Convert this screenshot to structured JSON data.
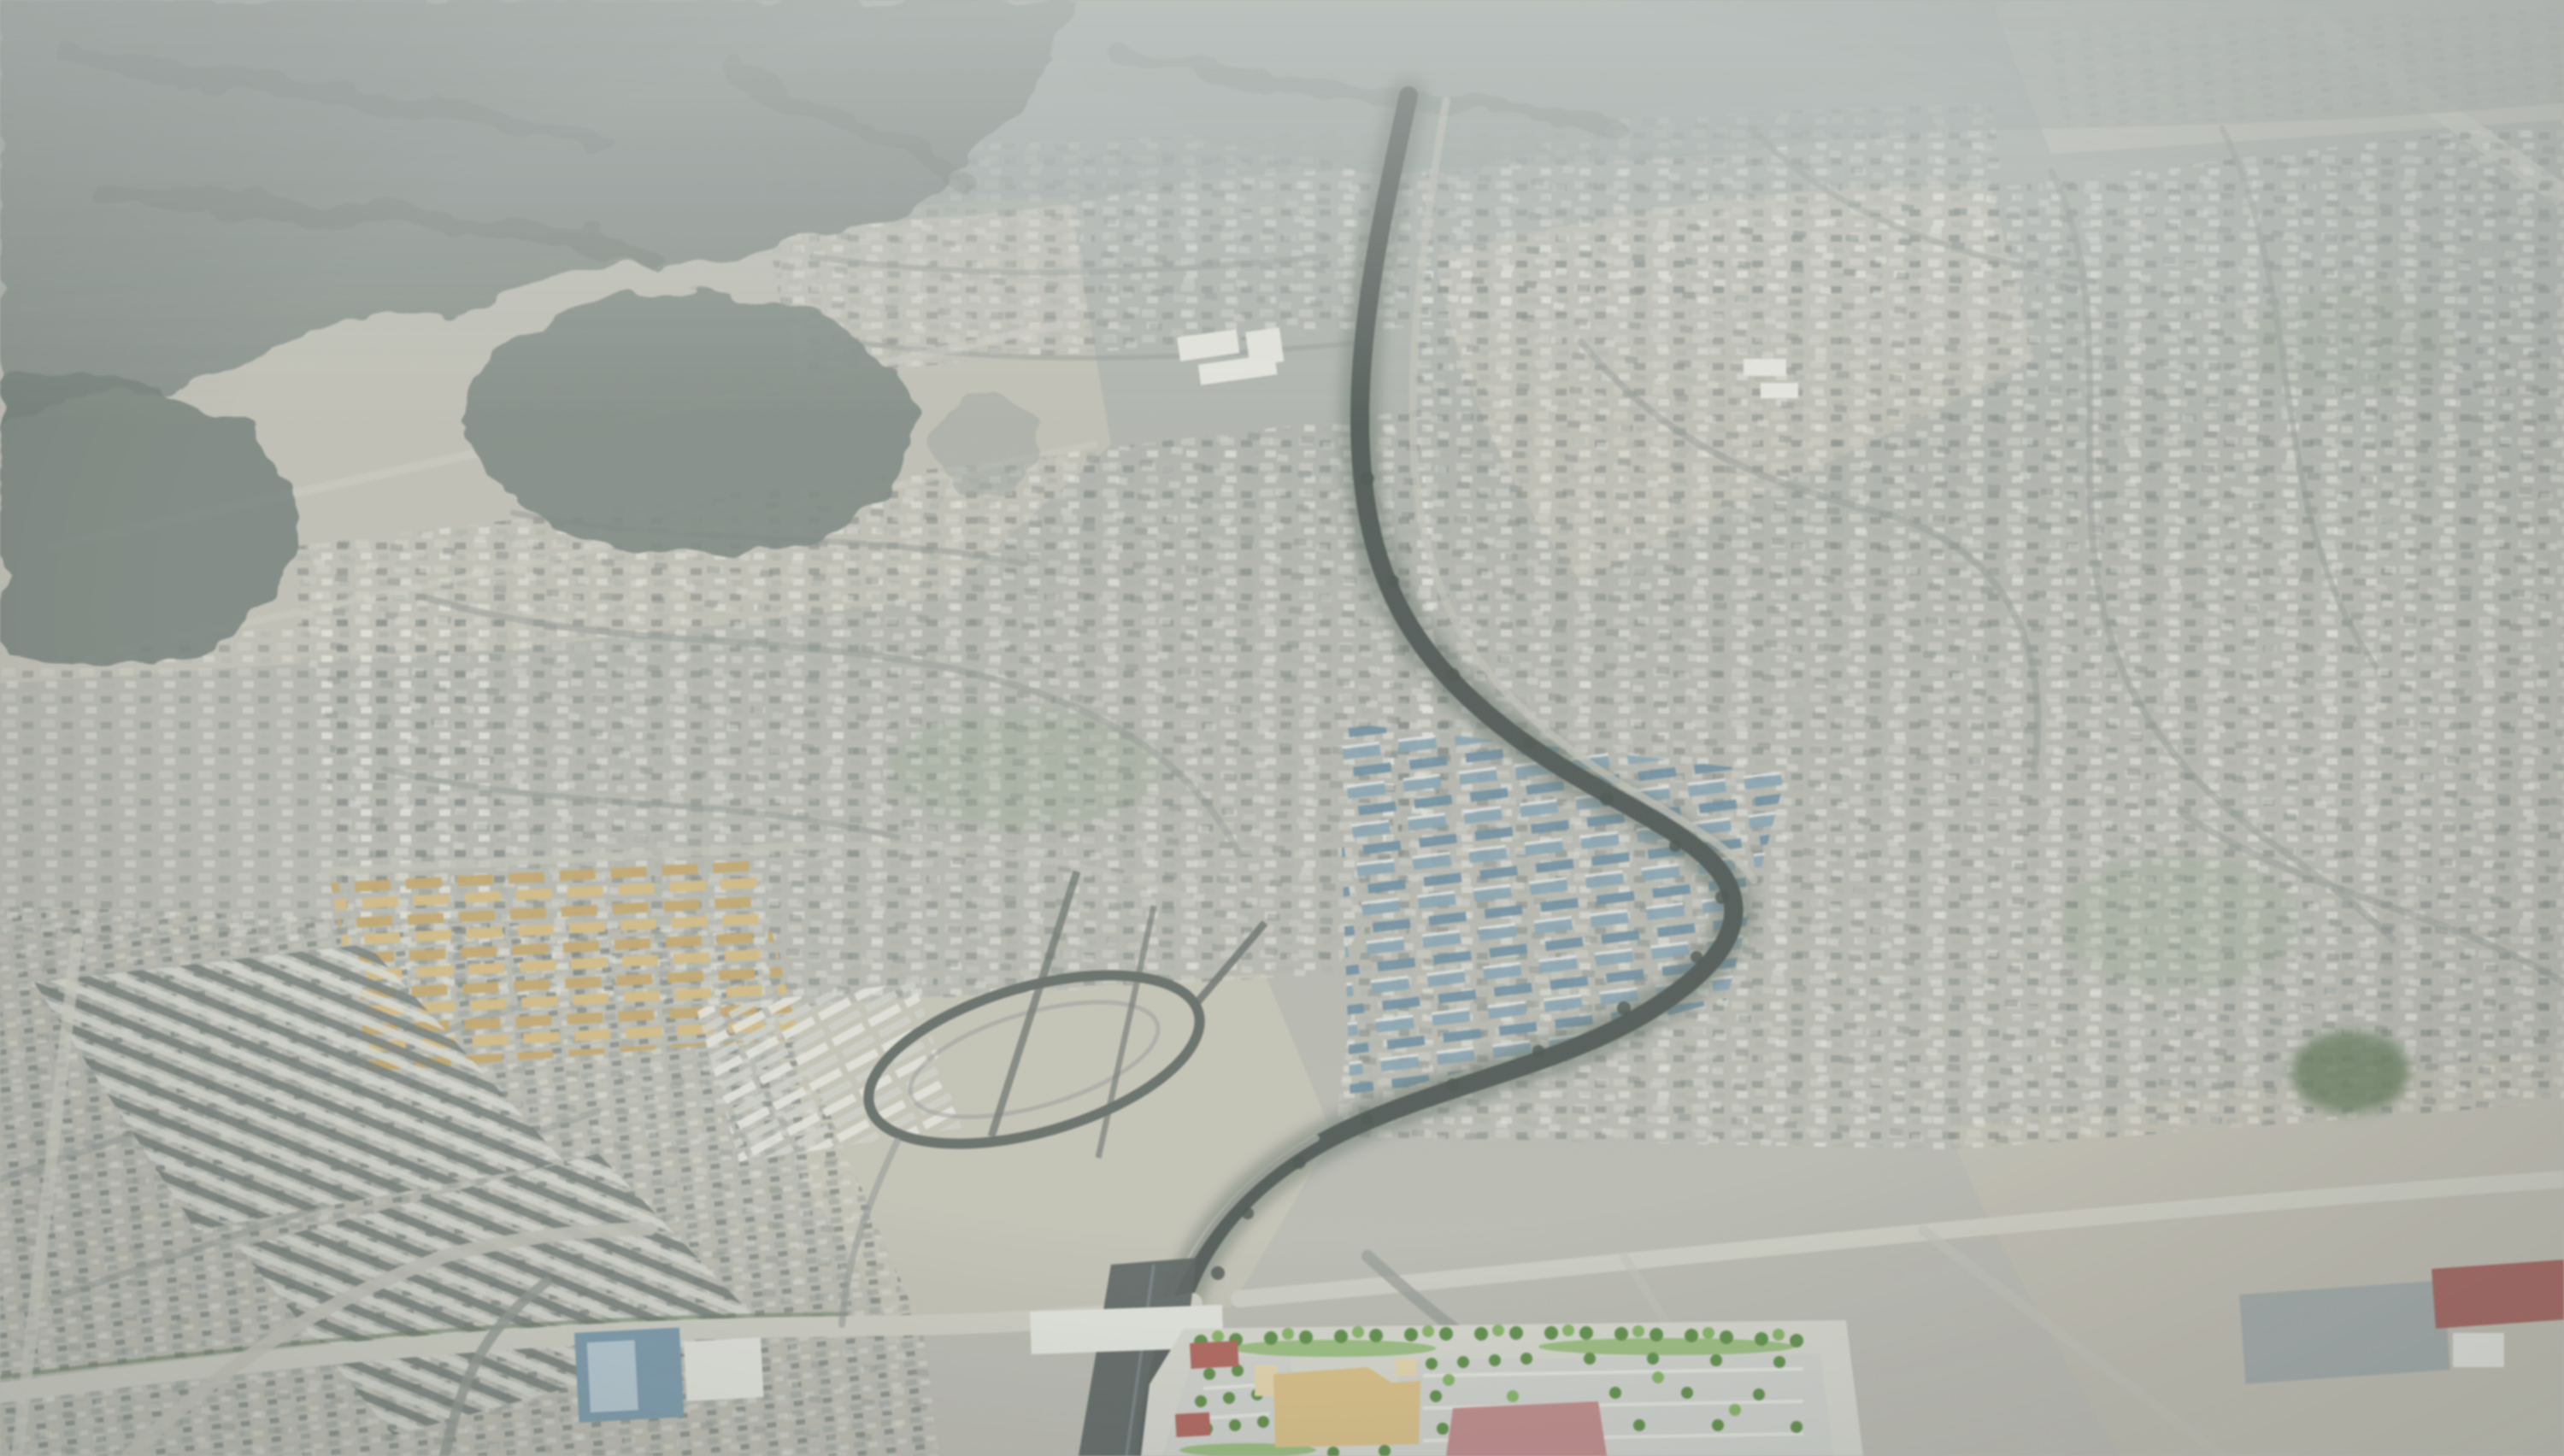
{
  "scene": {
    "type": "oblique-aerial-photograph",
    "subject": "desert-suburban-valley-with-mountains-winding-wash-and-development-rendering"
  },
  "palette": {
    "haze_top": "#a6aeaa",
    "haze_mid": "#b2b5ab",
    "haze_low": "#bcbdb0",
    "fog": "#cdd3d0",
    "mountain_far": "#97a29c",
    "mountain_near": "#7b8982",
    "mountain_dark": "#6b7a73",
    "mountain_shadow": "#5f6e67",
    "ridge_center": "#9aa7a0",
    "hill_left": "#75837c",
    "ground_light": "#c3c2b2",
    "sand_warm": "#c6c4b3",
    "sand_right": "#c2c0af",
    "distant_pale": "#c0c3b5",
    "wash_streak": "#cdd0c2",
    "suburb_base": "#b2b6aa",
    "roof_light": "#d3d4c8",
    "roof_dark": "#79837d",
    "roof_white": "#e9eae0",
    "roof_mid": "#a9b1a5",
    "suburb_mid2": "#9ba49c",
    "suburb_light": "#d6d8cb",
    "suburb_dark": "#717d77",
    "suburb_tan": "#c4c0ae",
    "street": "#8d968f",
    "street_dark": "#5b675f",
    "road_pale": "#cfd0c2",
    "road_light": "#c2c3b5",
    "channel": "#45524c",
    "channel_green": "#5d7060",
    "channel_dark": "#4f5b58",
    "channel_hl": "#8496a0",
    "tree_dark": "#3e4c44",
    "blue_roof": "#7ba2b6",
    "blue_roof_dark": "#5e8ba3",
    "blue_roof_gap": "#dfe6e6",
    "orange_roof": "#c9a457",
    "orange_roof_light": "#dab96e",
    "apartment_dark": "#6e7a76",
    "apartment_light": "#d9dcd2",
    "white_rows_gap": "#cfd4c9",
    "green_tint": "#7e9a6e",
    "golf_green": "#5d7a52",
    "blue_building": "#6f9ab2",
    "blue_building_light": "#b9d2dc",
    "white_building": "#e6e8e0",
    "gray_box": "#9faaa9",
    "red_building": "#b05a52",
    "pavement": "#57635f",
    "plan_ground": "#d7dbce",
    "plan_parking": "#d2d4cf",
    "plan_green": "#7ab84e",
    "plan_tree": "#4e8f31",
    "plan_yellow": "#e2c172",
    "plan_yellow_pale": "#ecd9a0",
    "plan_pink": "#cc8484",
    "plan_red": "#c05a4e",
    "car_row": "#eef0e6"
  },
  "effects": {
    "grain_opacity": "0.18",
    "wash_opacity": "0.10"
  }
}
